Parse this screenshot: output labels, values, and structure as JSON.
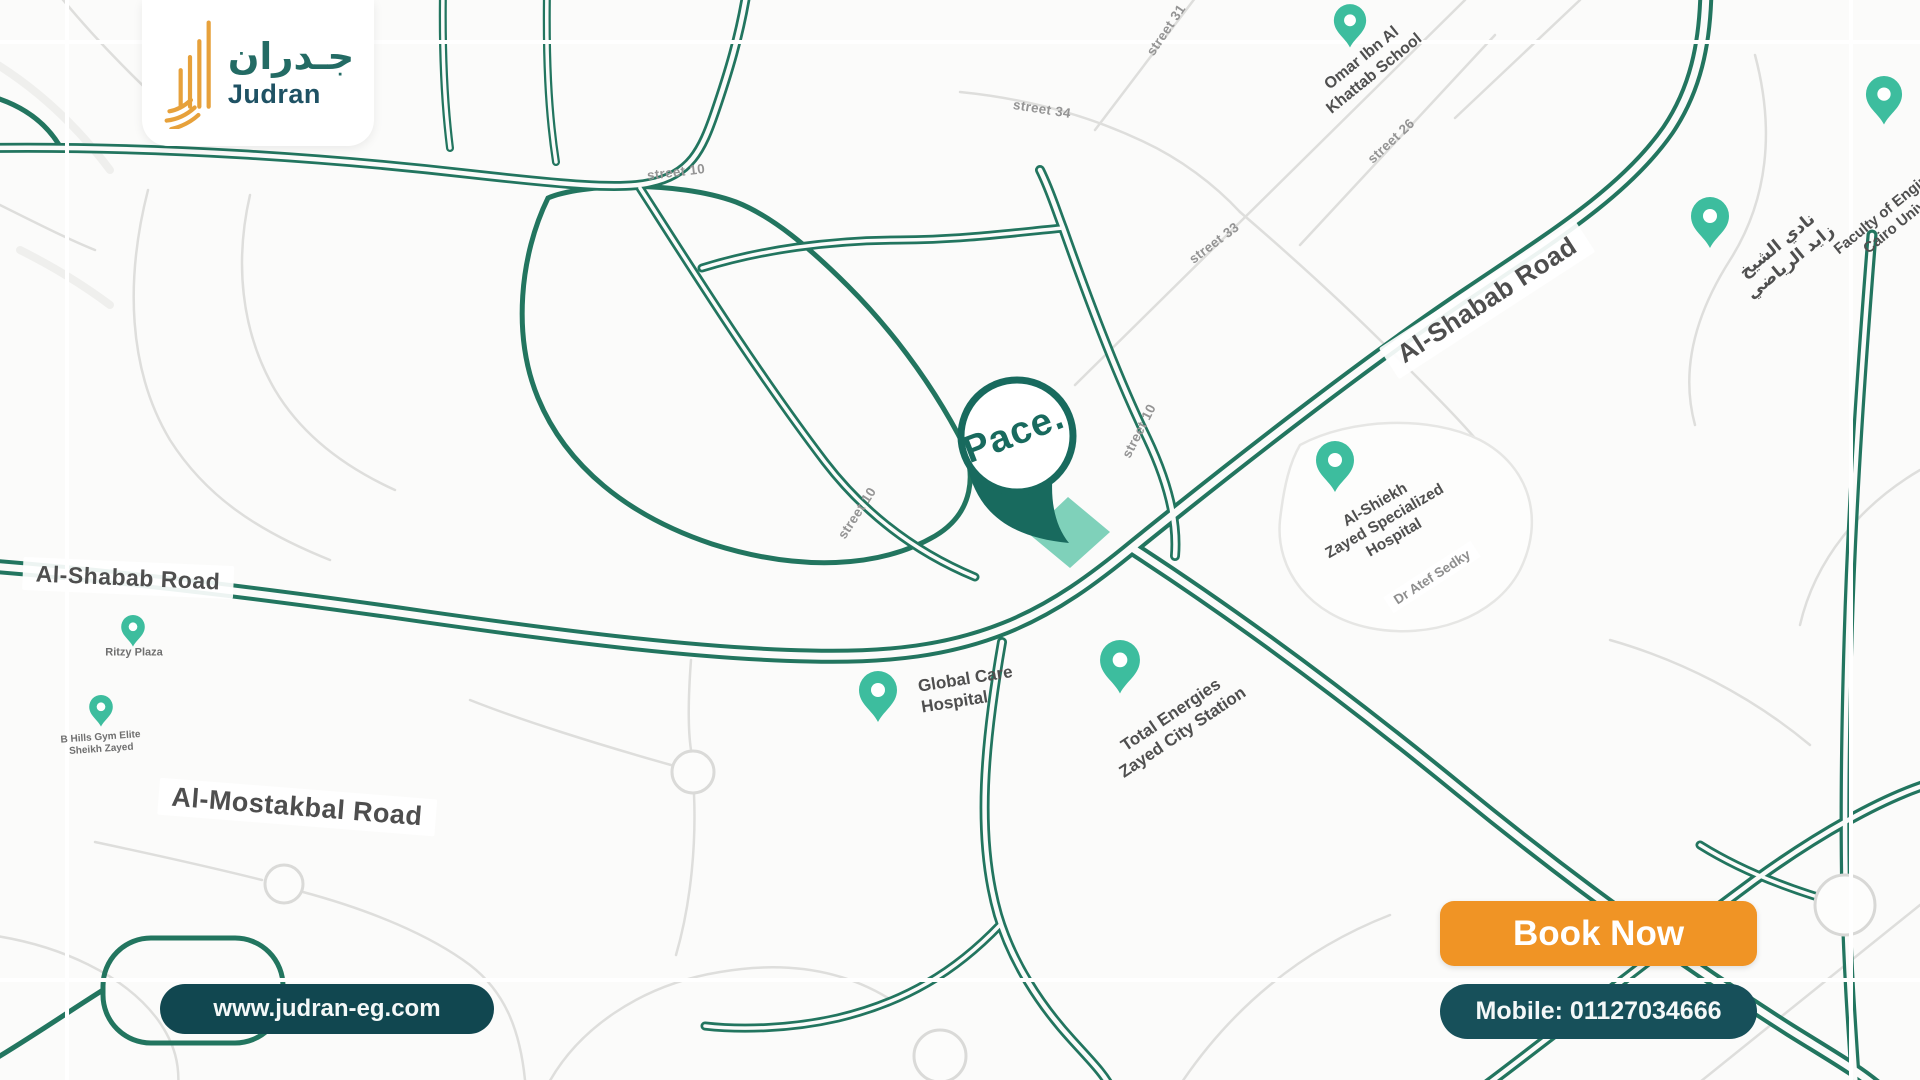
{
  "colors": {
    "accent_orange": "#F09425",
    "brand_teal": "#236B64",
    "road_teal": "#22755F",
    "pin_teal": "#3DBD9E",
    "pill_dark_teal": "#17505A",
    "plot_mint": "#7FD1BA"
  },
  "brand": {
    "logo_arabic": "جـدران",
    "logo_latin": "Judran"
  },
  "cta": {
    "book_now": "Book Now",
    "mobile": "Mobile: 01127034666",
    "website": "www.judran-eg.com"
  },
  "marker": {
    "label": "Pace."
  },
  "roads": {
    "al_shabab_left": "Al-Shabab Road",
    "al_shabab_ne": "Al-Shabab Road",
    "al_mostakbal": "Al-Mostakbal Road",
    "dr_atef_sedky": "Dr Atef Sedky"
  },
  "streets": {
    "s10_top": "street 10",
    "s10_left": "street 10",
    "s10_right": "street 10",
    "s31": "street 31",
    "s33": "street 33",
    "s34": "street 34",
    "s26": "street 26"
  },
  "pois": {
    "school": {
      "line1": "Omar Ibn Al",
      "line2": "Khattab School"
    },
    "faculty": {
      "line1": "Faculty of Engineering",
      "line2": "Cairo University"
    },
    "club": {
      "line1": "نادي الشيخ",
      "line2": "زايد الرياضي"
    },
    "zayed_hospital": {
      "line1": "Al-Shiekh",
      "line2": "Zayed Specialized",
      "line3": "Hospital"
    },
    "global_care": {
      "line1": "Global Care",
      "line2": "Hospital"
    },
    "total_station": {
      "line1": "Total Energies",
      "line2": "Zayed City Station"
    },
    "ritzy": {
      "line1": "Ritzy Plaza"
    },
    "gym": {
      "line1": "B Hills Gym Elite",
      "line2": "Sheikh Zayed"
    }
  }
}
